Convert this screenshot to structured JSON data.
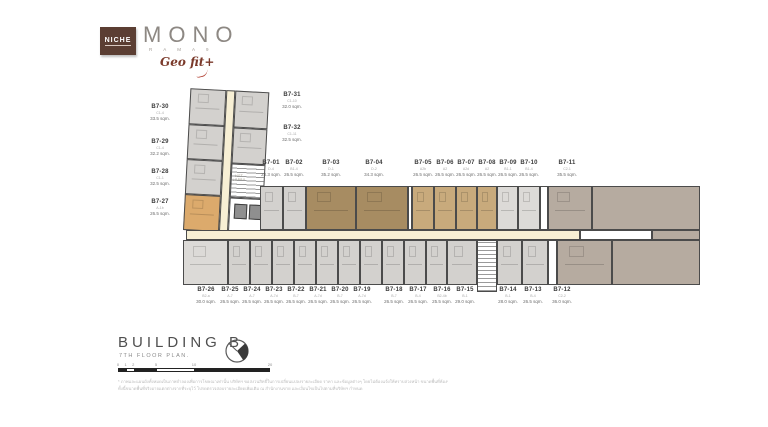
{
  "logo": {
    "niche": "NICHE",
    "brand": "MONO",
    "brand_sub": "R A M A 9",
    "script": "Geo fit+"
  },
  "footer": {
    "building": "BUILDING B",
    "floor": "7TH FLOOR PLAN.",
    "scale_labels": [
      "0",
      "1",
      "2",
      "5",
      "10",
      "20"
    ],
    "disclaimer1": "* ภาพและแผนผังทั้งหมดเป็นภาพจำลองเพื่อการโฆษณาเท่านั้น บริษัทฯ ขอสงวนสิทธิ์ในการเปลี่ยนแปลงรายละเอียด ราคา และข้อมูลต่างๆ โดยไม่ต้องแจ้งให้ทราบล่วงหน้า ขนาดพื้นที่ห้องชุดเป็นขนาดโดยประมาณ",
    "disclaimer2": "ทั้งนี้ขนาดพื้นที่จริงอาจแตกต่างจากที่ระบุไว้ โปรดตรวจสอบรายละเอียดเพิ่มเติม ณ สำนักงานขาย และเงื่อนไขเป็นไปตามที่บริษัทฯ กำหนด"
  },
  "plan": {
    "lift_lobby": "LIFT LOBBY",
    "colors": {
      "grey": "#d3d1ce",
      "grey_light": "#dcdad7",
      "brown": "#a78c62",
      "tan": "#c8aa7c",
      "taupe": "#b6aba0",
      "orange": "#dcaa6c",
      "corridor": "#f7efd4",
      "white": "#ffffff",
      "wall": "#4b4b4b"
    },
    "units": [
      {
        "id": "B7-01",
        "type": "D-4",
        "area": "28.3 sqm."
      },
      {
        "id": "B7-02",
        "type": "B1-4",
        "area": "26.5 sqm."
      },
      {
        "id": "B7-03",
        "type": "D-1",
        "area": "35.2 sqm."
      },
      {
        "id": "B7-04",
        "type": "D-2",
        "area": "34.3 sqm."
      },
      {
        "id": "B7-05",
        "type": "A2b",
        "area": "26.5 sqm."
      },
      {
        "id": "B7-06",
        "type": "A2",
        "area": "26.5 sqm."
      },
      {
        "id": "B7-07",
        "type": "A2d",
        "area": "26.5 sqm."
      },
      {
        "id": "B7-08",
        "type": "A2",
        "area": "26.5 sqm."
      },
      {
        "id": "B7-09",
        "type": "B1-1",
        "area": "26.5 sqm."
      },
      {
        "id": "B7-10",
        "type": "B1-4",
        "area": "26.5 sqm."
      },
      {
        "id": "B7-11",
        "type": "C2-1",
        "area": "35.5 sqm."
      },
      {
        "id": "B7-12",
        "type": "C2-2",
        "area": "36.0 sqm."
      },
      {
        "id": "B7-13",
        "type": "B-4",
        "area": "26.5 sqm."
      },
      {
        "id": "B7-14",
        "type": "B-1",
        "area": "28.0 sqm."
      },
      {
        "id": "B7-15",
        "type": "B-1",
        "area": "29.0 sqm."
      },
      {
        "id": "B7-16",
        "type": "B2-4b",
        "area": "25.5 sqm."
      },
      {
        "id": "B7-17",
        "type": "B-4",
        "area": "26.5 sqm."
      },
      {
        "id": "B7-18",
        "type": "B-7",
        "area": "26.5 sqm."
      },
      {
        "id": "B7-19",
        "type": "A-7d",
        "area": "26.5 sqm."
      },
      {
        "id": "B7-20",
        "type": "B-7",
        "area": "26.5 sqm."
      },
      {
        "id": "B7-21",
        "type": "A-7d",
        "area": "26.5 sqm."
      },
      {
        "id": "B7-22",
        "type": "B-7",
        "area": "26.5 sqm."
      },
      {
        "id": "B7-23",
        "type": "A-7d",
        "area": "26.5 sqm."
      },
      {
        "id": "B7-24",
        "type": "A-7",
        "area": "26.5 sqm."
      },
      {
        "id": "B7-25",
        "type": "A-7",
        "area": "26.5 sqm."
      },
      {
        "id": "B7-26",
        "type": "B2-a",
        "area": "30.0 sqm."
      },
      {
        "id": "B7-27",
        "type": "A-1b",
        "area": "26.5 sqm."
      },
      {
        "id": "B7-28",
        "type": "C1-1",
        "area": "32.5 sqm."
      },
      {
        "id": "B7-29",
        "type": "C1-4",
        "area": "32.2 sqm."
      },
      {
        "id": "B7-30",
        "type": "C1-4",
        "area": "33.5 sqm."
      },
      {
        "id": "B7-31",
        "type": "C1-10",
        "area": "32.0 sqm."
      },
      {
        "id": "B7-32",
        "type": "C1-11",
        "area": "32.5 sqm."
      }
    ]
  }
}
